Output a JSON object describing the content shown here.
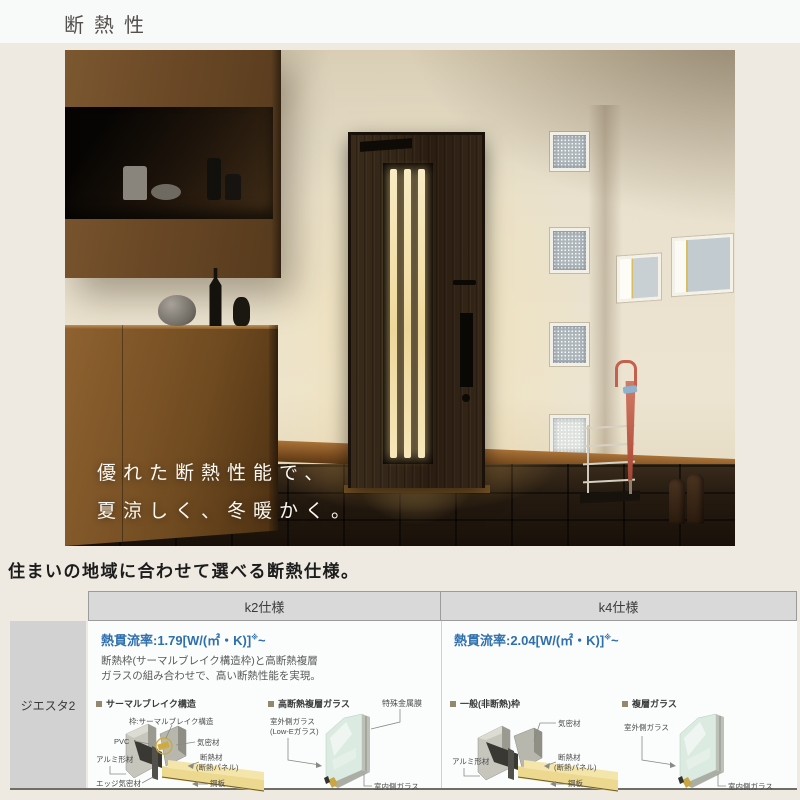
{
  "page": {
    "title": "断熱性"
  },
  "hero": {
    "caption_line1": "優れた断熱性能で、",
    "caption_line2": "夏涼しく、冬暖かく。"
  },
  "section_heading": "住まいの地域に合わせて選べる断熱仕様。",
  "spec_table": {
    "row_label": "ジエスタ2",
    "columns": [
      {
        "header": "k2仕様",
        "u_value": "熱貫流率:1.79[W/(㎡・K)]",
        "u_note": "※",
        "u_range": "~",
        "desc1": "断熱枠(サーマルブレイク構造枠)と高断熱複層",
        "desc2": "ガラスの組み合わせで、高い断熱性能を実現。",
        "frame": {
          "title": "サーマルブレイク構造",
          "label_top": "枠:サーマルブレイク構造",
          "label_pvc": "PVC",
          "label_airtight": "気密材",
          "label_alumi": "アルミ形材",
          "label_ins1": "断熱材",
          "label_ins2": "(断熱パネル)",
          "label_edge": "エッジ気密材",
          "label_steel": "鋼板"
        },
        "glass": {
          "title": "高断熱複層ガラス",
          "label_film": "特殊金属膜",
          "label_out1": "室外側ガラス",
          "label_out2": "(Low-Eガラス)",
          "label_in": "室内側ガラス"
        }
      },
      {
        "header": "k4仕様",
        "u_value": "熱貫流率:2.04[W/(㎡・K)]",
        "u_note": "※",
        "u_range": "~",
        "frame": {
          "title": "一般(非断熱)枠",
          "label_airtight": "気密材",
          "label_alumi": "アルミ形材",
          "label_ins1": "断熱材",
          "label_ins2": "(断熱パネル)",
          "label_steel": "鋼板"
        },
        "glass": {
          "title": "複層ガラス",
          "label_out1": "室外側ガラス",
          "label_in": "室内側ガラス"
        }
      }
    ]
  },
  "colors": {
    "accent_blue": "#2e6fad",
    "table_header_bg": "#d9d9d9",
    "row_label_bg": "#d2d2d2",
    "page_bg": "#eeeae1",
    "door_glow": "#f6d88c"
  }
}
